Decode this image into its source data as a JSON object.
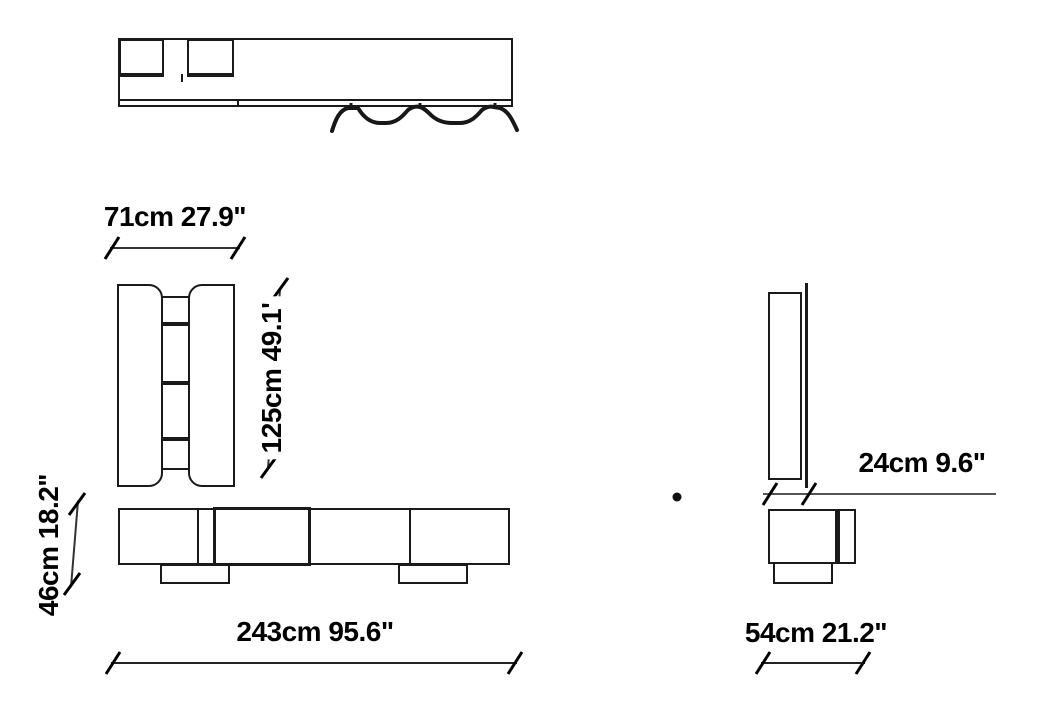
{
  "page": {
    "background": "#ffffff",
    "line_color": "#1a1a1a",
    "dim_line_color": "#555555"
  },
  "dimensions": {
    "top_width": {
      "label": "71cm 27.9\""
    },
    "panel_height": {
      "label": "125cm 49.1'"
    },
    "base_height": {
      "label": "46cm 18.2\""
    },
    "total_width": {
      "label": "243cm 95.6\""
    },
    "panel_depth": {
      "label": "24cm 9.6\""
    },
    "base_depth": {
      "label": "54cm 21.2\""
    }
  }
}
